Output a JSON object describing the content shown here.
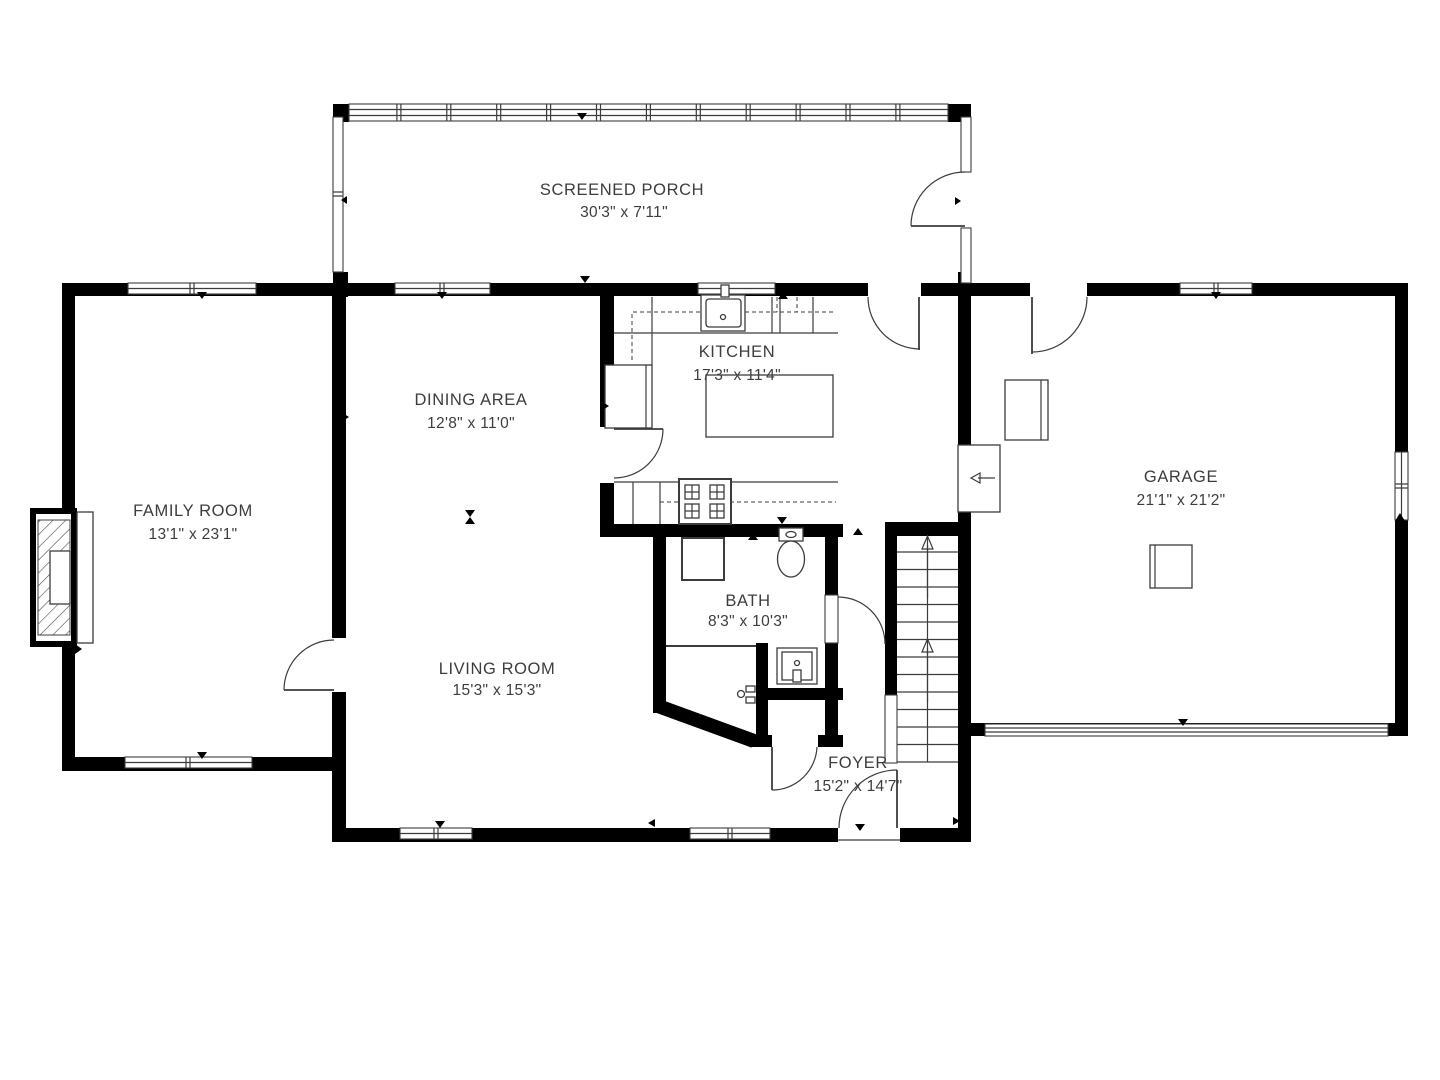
{
  "colors": {
    "wall": "#000000",
    "ink": "#3d3d3d",
    "line": "#3c3c3c",
    "bg": "#ffffff"
  },
  "rooms": [
    {
      "id": "screened-porch",
      "name": "SCREENED PORCH",
      "dims": "30'3\" x 7'11\""
    },
    {
      "id": "kitchen",
      "name": "KITCHEN",
      "dims": "17'3\" x 11'4\""
    },
    {
      "id": "dining-area",
      "name": "DINING AREA",
      "dims": "12'8\" x 11'0\""
    },
    {
      "id": "family-room",
      "name": "FAMILY ROOM",
      "dims": "13'1\" x 23'1\""
    },
    {
      "id": "garage",
      "name": "GARAGE",
      "dims": "21'1\" x 21'2\""
    },
    {
      "id": "bath",
      "name": "BATH",
      "dims": "8'3\" x 10'3\""
    },
    {
      "id": "living-room",
      "name": "LIVING ROOM",
      "dims": "15'3\" x 15'3\""
    },
    {
      "id": "foyer",
      "name": "FOYER",
      "dims": "15'2\" x 14'7\""
    }
  ]
}
